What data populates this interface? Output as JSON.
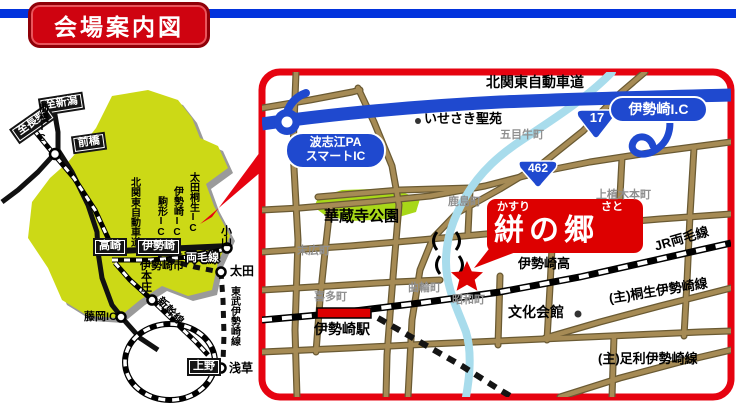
{
  "header": {
    "title": "会場案内図"
  },
  "overview": {
    "to_niigata": "至新潟",
    "to_nagano": "至長野",
    "maebashi": "前橋",
    "maebashi_ic": "前橋IC",
    "kitakanto_expwy": "北関東自動車道",
    "komagata_ic": "駒形IC",
    "isesaki_ic": "伊勢崎IC",
    "ota_kiryu_ic": "太田桐生IC",
    "takasaki": "高崎",
    "isesaki": "伊勢崎",
    "isesaki_city": "伊勢崎市",
    "ryomo_line": "両毛線",
    "oyama": "小山",
    "ota": "太田",
    "tobu_isesaki_line": "東武伊勢崎線",
    "honjo": "本庄",
    "shinkansen": "新幹線",
    "fujioka_ic": "藤岡IC",
    "ueno": "上野",
    "asakusa": "浅草"
  },
  "detail": {
    "kitakanto_expwy": "北関東自動車道",
    "isesaki_ic": "伊勢崎I.C",
    "route17": "17",
    "route462": "462",
    "isesaki_seien": "いせさき聖苑",
    "gomeushi_cho": "五目牛町",
    "hashie_pa_line1": "波志江PA",
    "hashie_pa_line2": "スマートIC",
    "kezoji_park": "華蔵寺公園",
    "suehiro_cho": "末広町",
    "kashima_cho": "鹿島町",
    "kamiueki_hon_cho": "上植木本町",
    "venue_furigana1": "かすり",
    "venue_furigana2": "さと",
    "venue_name": "絣の郷",
    "isesaki_high": "伊勢崎高",
    "jr_ryomo_line": "JR両毛線",
    "kuruwa_cho": "曲輪町",
    "showa_cho": "昭和町",
    "kita_cho": "喜多町",
    "bunka_kaikan": "文化会館",
    "isesaki_station": "伊勢崎駅",
    "kiryu_isesaki_line": "(主)桐生伊勢崎線",
    "ashikaga_isesaki_line": "(主)足利伊勢崎線"
  },
  "colors": {
    "accent_red": "#cf0310",
    "expressway_blue": "#1f49cf",
    "prefecture_yellow": "#ccd916",
    "road_tan": "#a68b55",
    "river_blue": "#a8dcec",
    "park_green": "#a8d818"
  }
}
